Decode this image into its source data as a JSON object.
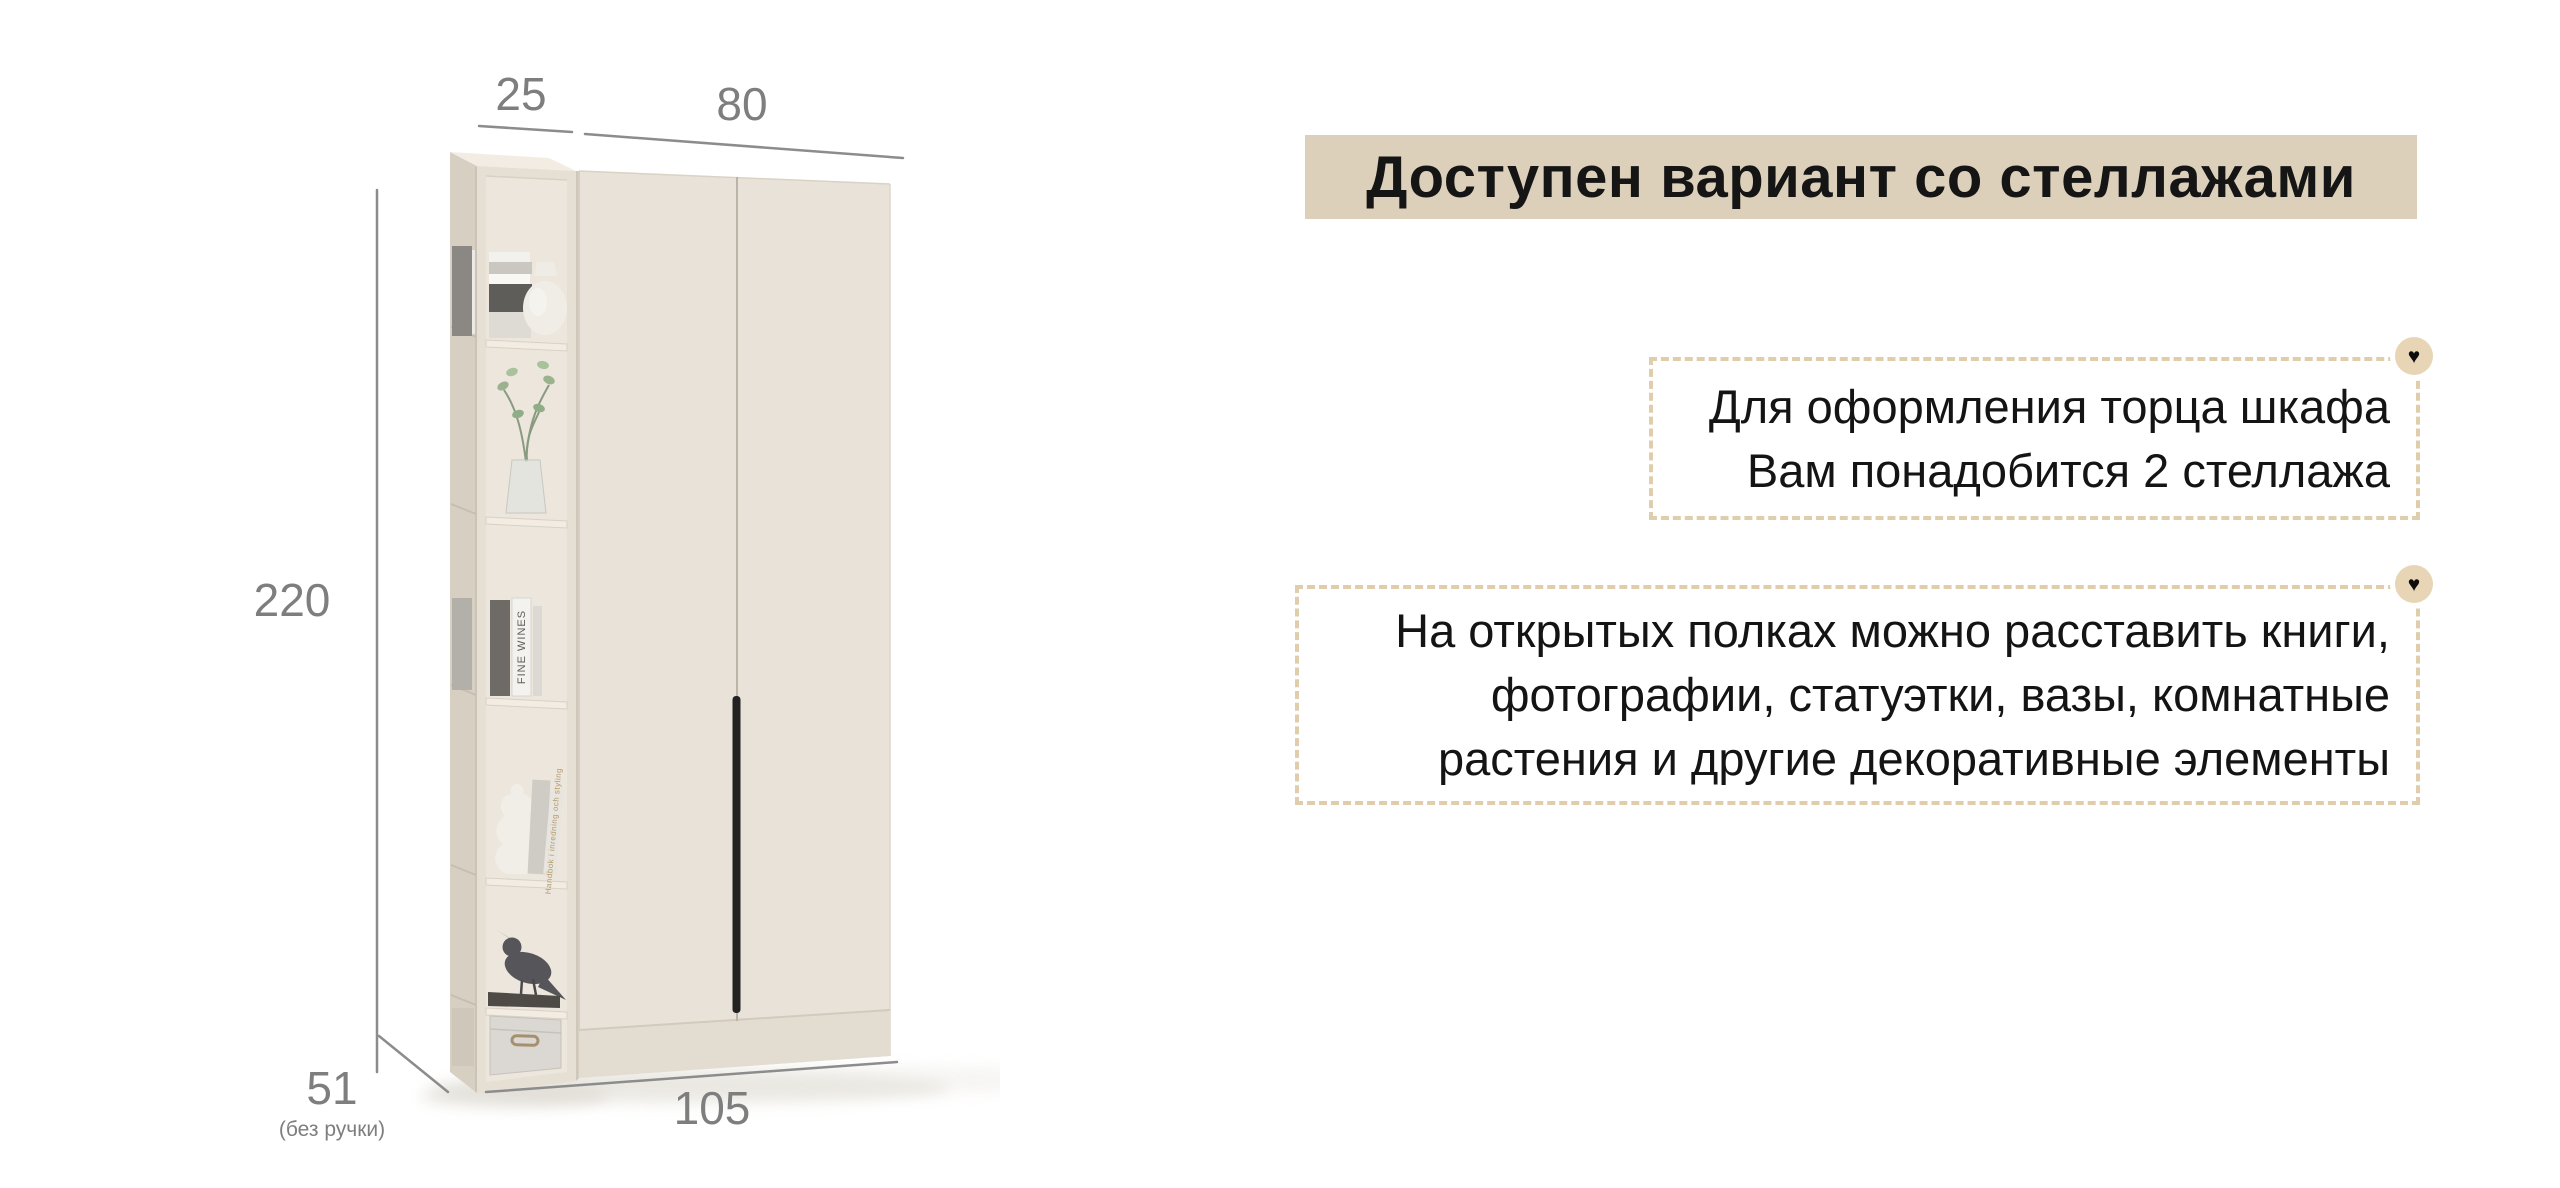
{
  "banner": {
    "label": "Доступен вариант со стеллажами",
    "bg": "#ddd0ba"
  },
  "callouts": [
    {
      "lines": [
        "Для оформления торца шкафа",
        "Вам понадобится 2 стеллажа"
      ]
    },
    {
      "lines": [
        "На открытых полках можно расставить книги,",
        "фотографии, статуэтки, вазы, комнатные",
        "растения и другие декоративные элементы"
      ]
    }
  ],
  "icons": {
    "heart_glyph": "♥"
  },
  "dimensions": {
    "shelf_width": "25",
    "wardrobe_width": "80",
    "height": "220",
    "depth": "51",
    "depth_note": "(без ручки)",
    "total_width": "105"
  },
  "decor": {
    "book_spine_1": "FINE WINES",
    "book_spine_2": "Handbok i inredning och styling"
  },
  "colors": {
    "background": "#ffffff",
    "banner_bg": "#ddd0ba",
    "dashed_border": "#dfcdab",
    "heart_badge_bg": "#e7d5b6",
    "dimension_text": "#7e7e7e",
    "furniture_front": "#e9e2d8",
    "furniture_side": "#d7cfc2",
    "handle": "#222222"
  }
}
